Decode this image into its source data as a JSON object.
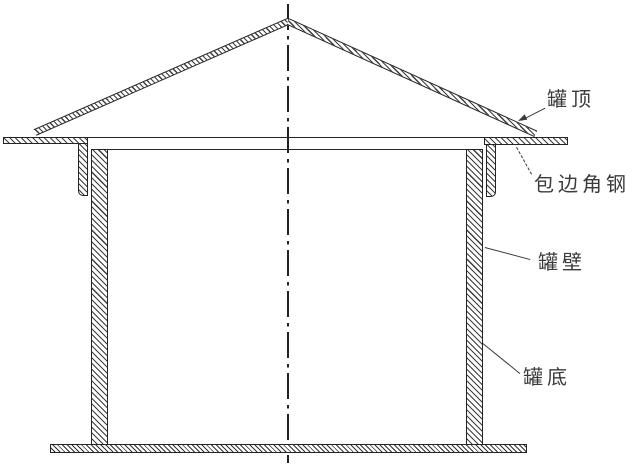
{
  "labels": {
    "roof": "罐顶",
    "edge_angle": "包边角钢",
    "wall": "罐壁",
    "bottom": "罐底"
  },
  "colors": {
    "background": "#ffffff",
    "line": "#262626",
    "text": "#3b3b3b"
  }
}
